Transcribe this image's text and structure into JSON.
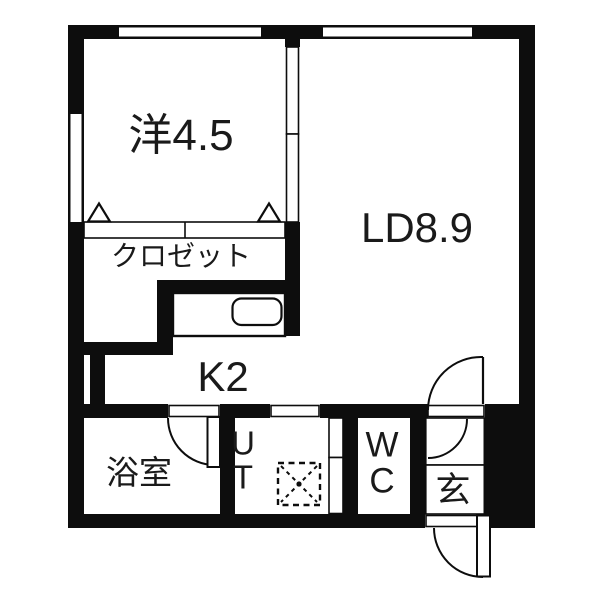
{
  "plan": {
    "type": "floor-plan",
    "rooms": [
      {
        "id": "western-room",
        "label": "洋4.5"
      },
      {
        "id": "closet",
        "label": "クロゼット"
      },
      {
        "id": "living-dining",
        "label": "LD8.9"
      },
      {
        "id": "kitchen",
        "label": "K2"
      },
      {
        "id": "bathroom",
        "label": "浴室"
      },
      {
        "id": "utility",
        "label": "UT"
      },
      {
        "id": "toilet",
        "label": "WC"
      },
      {
        "id": "entrance",
        "label": "玄"
      }
    ],
    "colors": {
      "wall": "#0d0d0d",
      "line": "#1a1a1a",
      "background": "#ffffff"
    }
  }
}
